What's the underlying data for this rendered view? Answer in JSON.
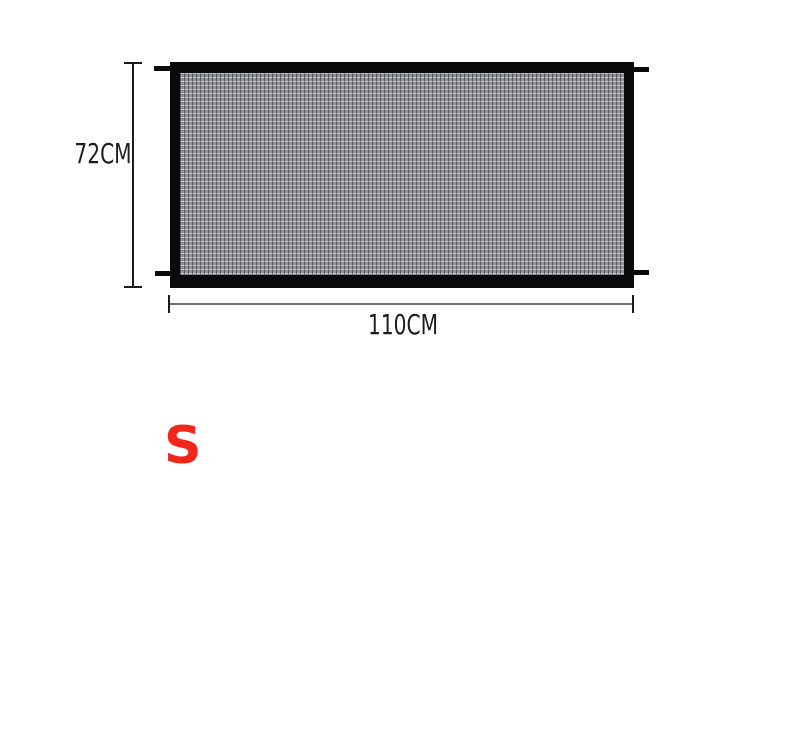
{
  "scene": {
    "background_color": "#ffffff",
    "description": "product size diagram of a mesh safety gate"
  },
  "product_diagram": {
    "name": "mesh-gate",
    "frame_color": "#0a0a0a",
    "mesh": {
      "base_color": "#9fa1a7",
      "light_color": "#c8cacd",
      "dark_color": "#8e9096"
    },
    "height_dimension": {
      "label": "72CM"
    },
    "width_dimension": {
      "label": "110CM"
    },
    "annotation_color": "#1c1c1c",
    "line_color": "#707070"
  },
  "size_option": {
    "label": "S",
    "color": "#f0271b"
  }
}
